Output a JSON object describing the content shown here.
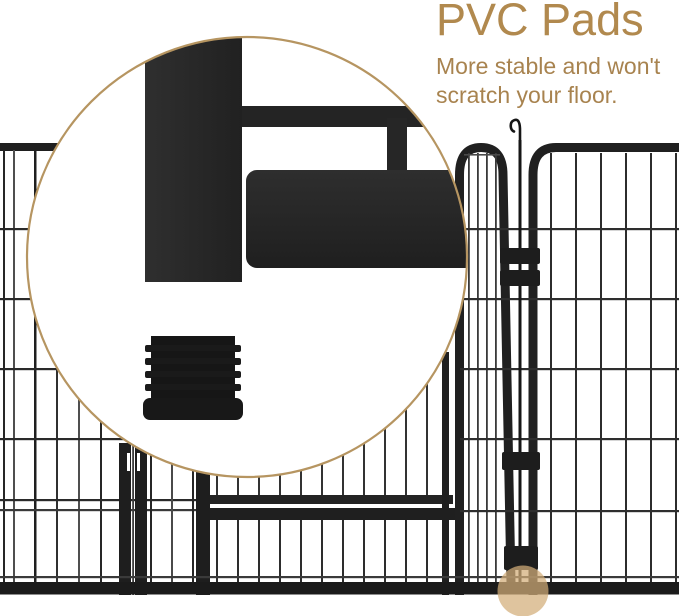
{
  "header": {
    "title": "PVC Pads",
    "subtitle_lines": [
      "More stable and won't",
      "scratch your floor."
    ]
  },
  "illustration": {
    "magnifier_content": "fence corner tube and ribbed pvc foot pad plug",
    "scene": "metal playpen panels with open gate, arched door panels and hook connector pin",
    "highlight_dot": "tan translucent dot marking pad position at panel foot"
  },
  "colors": {
    "background": "#ffffff",
    "accent_gold": "#b1894e",
    "subtitle_gold": "#a8834f",
    "magnifier_ring_gold": "#b69561",
    "fence_black": "#202020",
    "magnified_black": "#282828",
    "highlight_dot_tan": "#d3ad78"
  }
}
